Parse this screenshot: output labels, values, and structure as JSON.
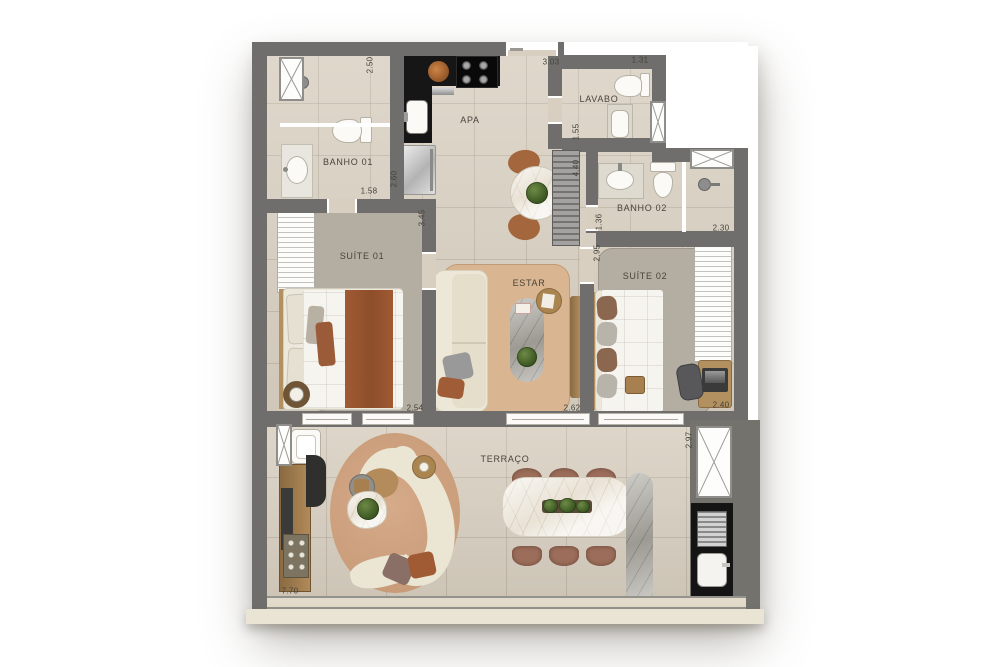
{
  "plan": {
    "rooms": {
      "banho01": "BANHO 01",
      "apa": "APA",
      "lavabo": "LAVABO",
      "banho02": "BANHO 02",
      "suite01": "SUÍTE 01",
      "estar": "ESTAR",
      "suite02": "SUÍTE 02",
      "terraco": "TERRAÇO"
    },
    "dimensions": {
      "banho01_shower": "2.50",
      "apa_width": "3.03",
      "lavabo_width": "1.31",
      "banho01_width": "1.58",
      "lavabo_depth": "1.55",
      "apa_counter": "2.60",
      "suite01_depth": "3.45",
      "stair_run": "4.40",
      "banho02_depth": "1.36",
      "banho02_width": "2.30",
      "suite02_depth": "2.95",
      "suite01_width": "2.54",
      "estar_width": "2.62",
      "suite02_width": "2.40",
      "terraco_depth": "2.97",
      "terraco_width": "7.70"
    },
    "colors": {
      "wall": "#6f6e6c",
      "floor": "#d8cfc0",
      "suite_rug": "#b4ada2",
      "estar_rug": "#d9b592",
      "terrace_rug": "#cfa183",
      "counter_black": "#161616",
      "wood": "#b08a58"
    }
  }
}
